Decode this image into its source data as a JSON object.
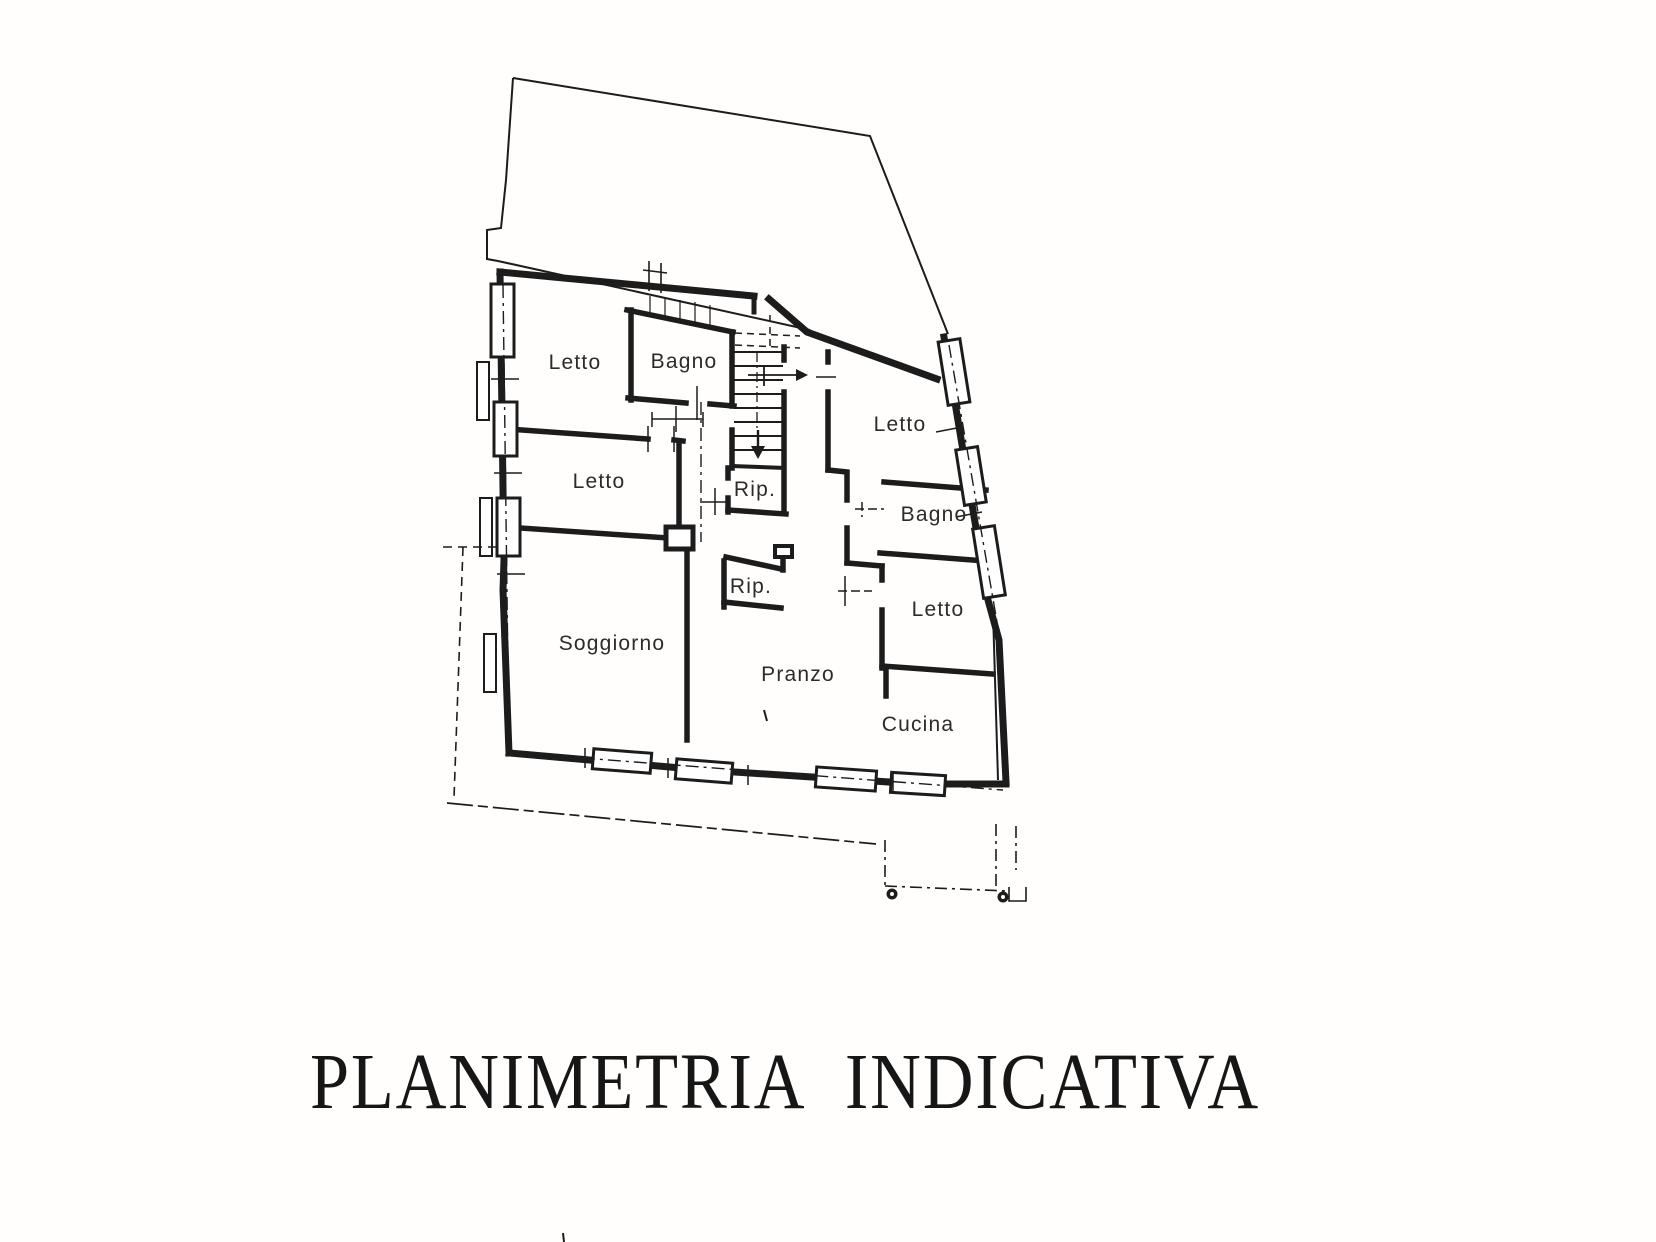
{
  "title": "PLANIMETRIA INDICATIVA",
  "colors": {
    "ink": "#1c1c1c",
    "paper": "#ffffff"
  },
  "plan": {
    "rooms": [
      {
        "id": "letto-1",
        "label": "Letto"
      },
      {
        "id": "bagno-1",
        "label": "Bagno"
      },
      {
        "id": "letto-2",
        "label": "Letto"
      },
      {
        "id": "rip-1",
        "label": "Rip."
      },
      {
        "id": "letto-3",
        "label": "Letto"
      },
      {
        "id": "bagno-2",
        "label": "Bagno"
      },
      {
        "id": "rip-2",
        "label": "Rip."
      },
      {
        "id": "letto-4",
        "label": "Letto"
      },
      {
        "id": "soggiorno",
        "label": "Soggiorno"
      },
      {
        "id": "pranzo",
        "label": "Pranzo"
      },
      {
        "id": "cucina",
        "label": "Cucina"
      }
    ]
  }
}
